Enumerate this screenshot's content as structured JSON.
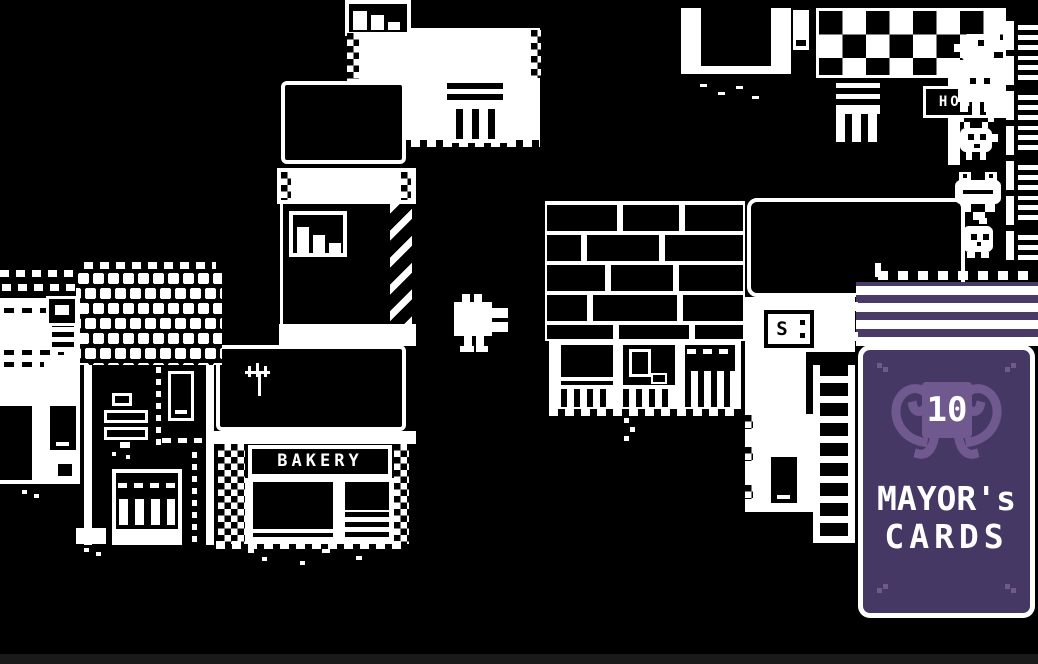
{
  "scene": {
    "bakery_sign": "BAKERY",
    "hotel_sign": "HOH",
    "vent_sign": "S"
  },
  "hud": {
    "card_count": "10",
    "card_title_line1": "MAYOR's",
    "card_title_line2": "CARDS"
  },
  "sprites": {
    "player": "duck-player",
    "npcs": [
      "bird",
      "ghost",
      "beetle",
      "frog",
      "sprout"
    ]
  },
  "colors": {
    "background": "#000000",
    "foreground": "#ffffff",
    "card_purple": "#463864",
    "card_purple_dark": "#4a3a66",
    "card_accent": "#70598e"
  }
}
